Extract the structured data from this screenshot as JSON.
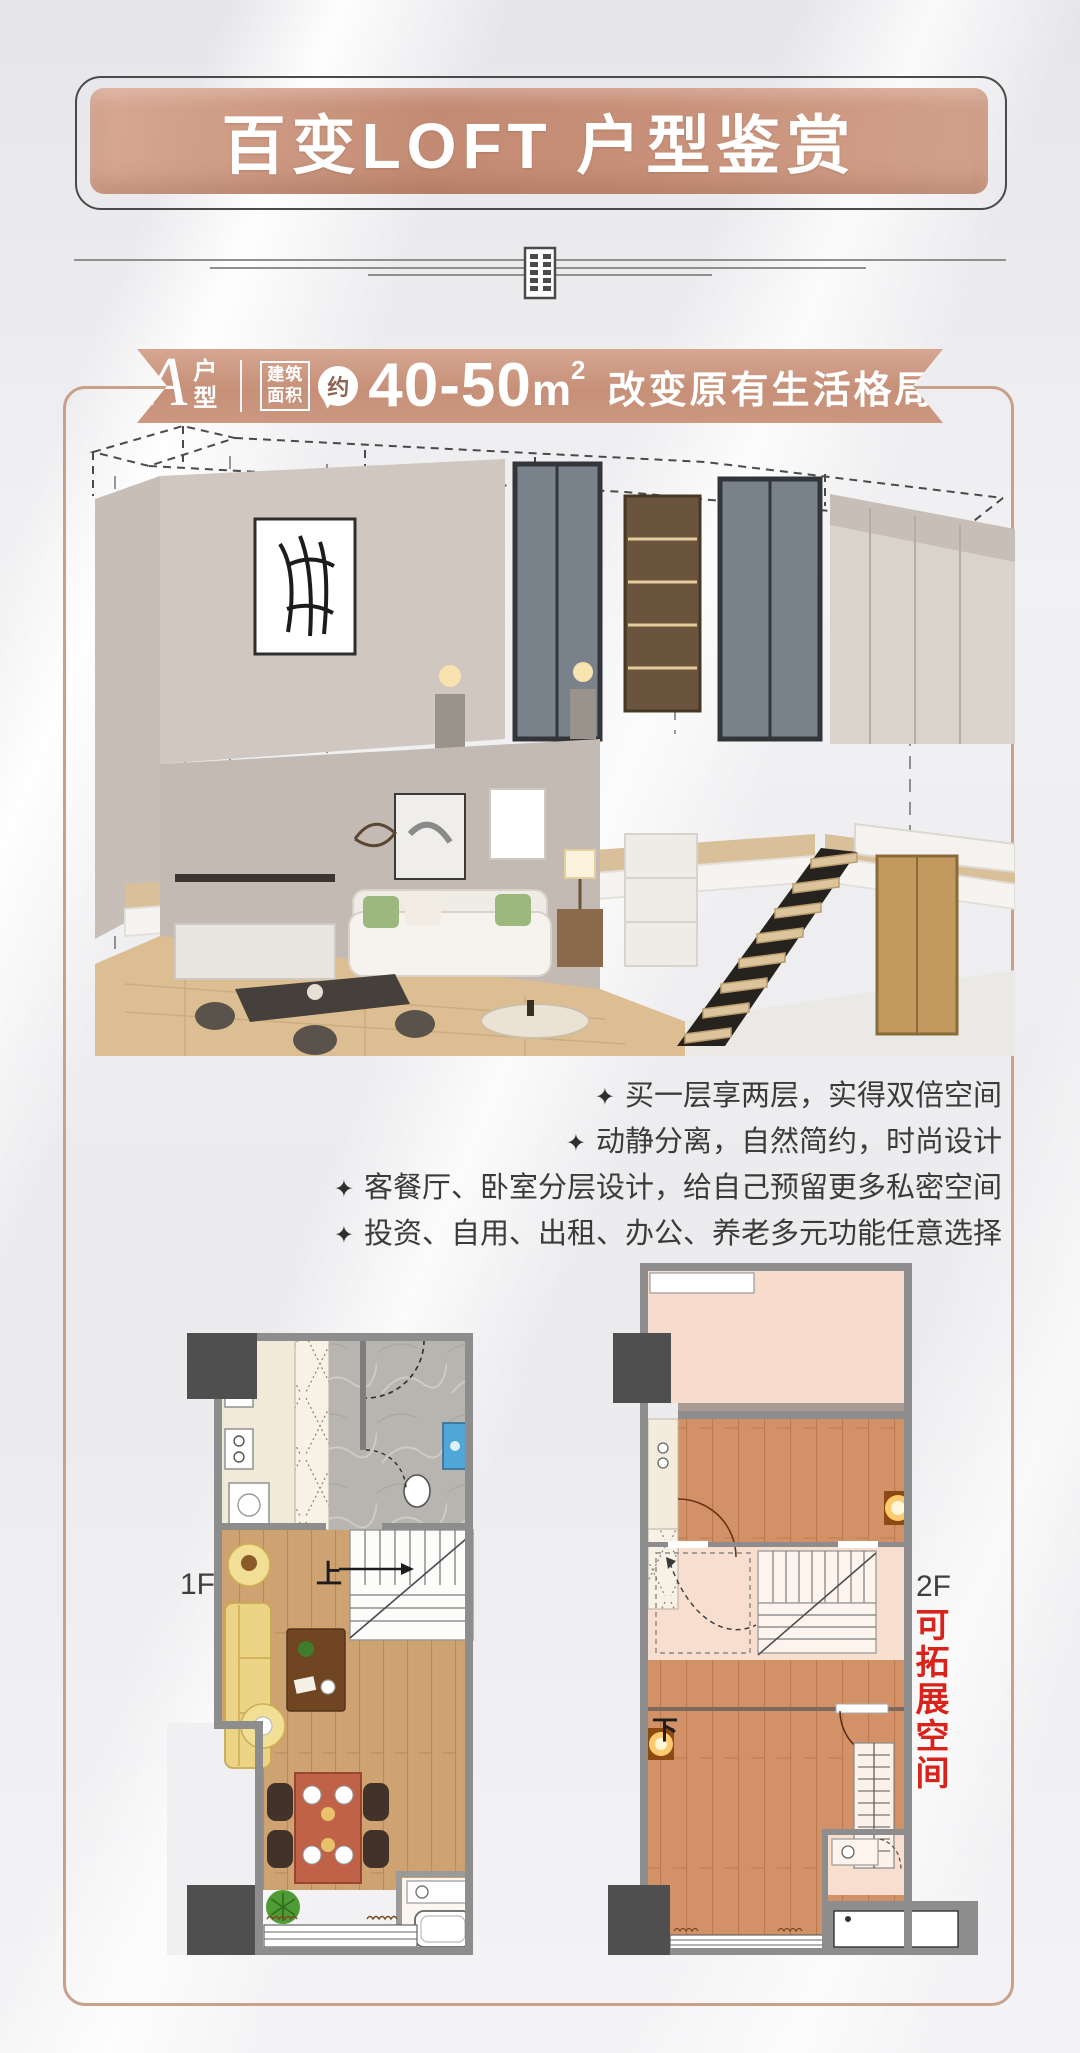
{
  "header": {
    "title": "百变LOFT 户型鉴赏"
  },
  "divider": {
    "icon": "building-icon"
  },
  "badge": {
    "plan_letter": "A",
    "plan_type": "户型",
    "area_caption": [
      "建筑",
      "面积"
    ],
    "approx": "约",
    "area_range": "40-50",
    "area_unit": "m",
    "area_exponent": "2",
    "slogan": "改变原有生活格局"
  },
  "features": {
    "marker": "✦",
    "items": [
      "买一层享两层，实得双倍空间",
      "动静分离，自然简约，时尚设计",
      "客餐厅、卧室分层设计，给自己预留更多私密空间",
      "投资、自用、出租、办公、养老多元功能任意选择"
    ]
  },
  "floor_plans": {
    "first": {
      "label": "1F",
      "stair": "上"
    },
    "second": {
      "label": "2F",
      "stair": "下",
      "note": "可拓展空间"
    }
  },
  "colors": {
    "copper": "#c68f78",
    "frame_border": "#c9a08a",
    "note_red": "#d9231a",
    "wall_gray": "#8d8d8d",
    "column_dark": "#4f4f4f"
  }
}
